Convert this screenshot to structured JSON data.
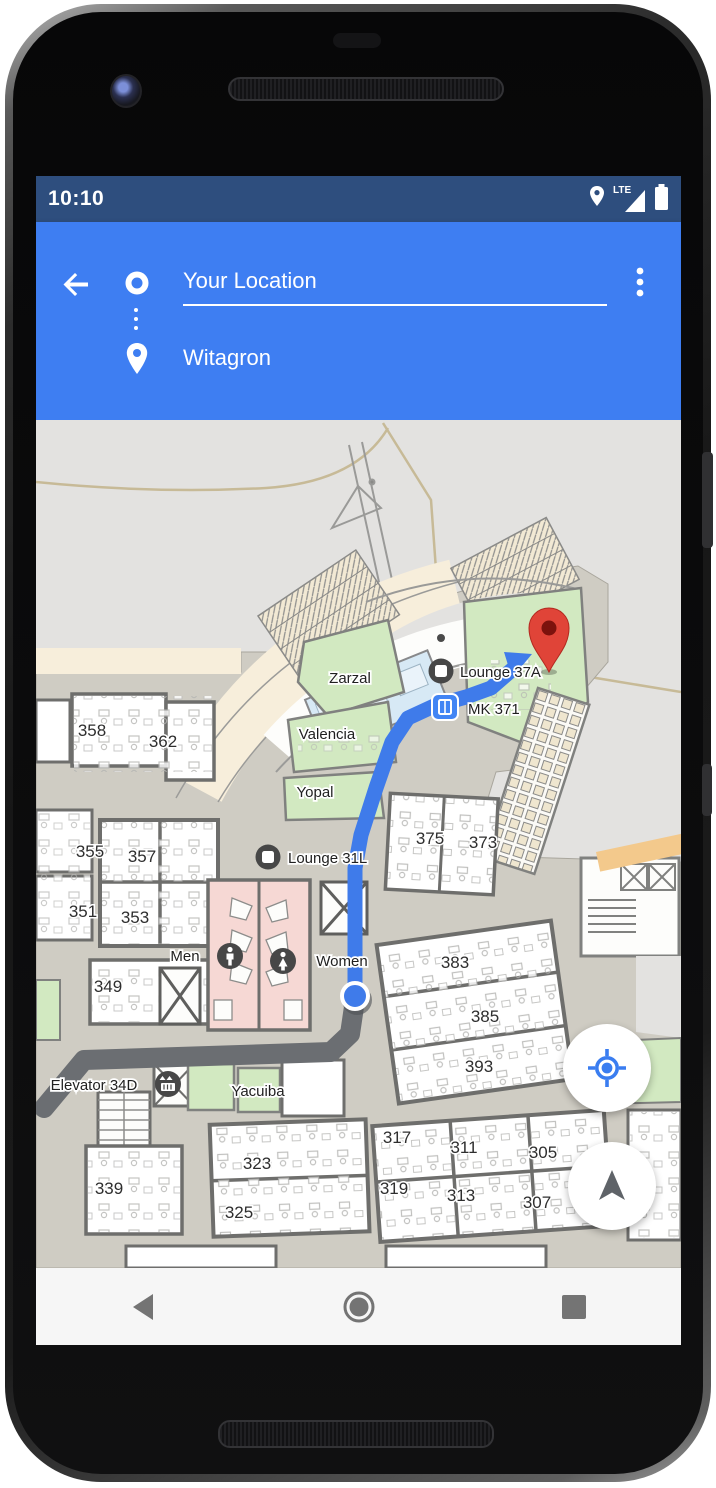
{
  "status_bar": {
    "time": "10:10",
    "network_label": "LTE",
    "icons": [
      "location-pin",
      "signal-triangle",
      "battery-full"
    ]
  },
  "directions_header": {
    "origin_value": "Your Location",
    "destination_value": "Witagron",
    "accent_color": "#3e7ef2",
    "status_color": "#2e4e7e"
  },
  "map": {
    "colors": {
      "outdoor": "#e3e2e0",
      "corridor": "#cfccc3",
      "building_trim": "#f7eedb",
      "room_green": "#d2e9c1",
      "room_pink": "#f6d8d4",
      "room_blue": "#d7e9f5",
      "route_blue": "#3f7bea",
      "route_gray": "#6b6e72",
      "pin_red": "#e04438",
      "accent_strip": "#f3c98c"
    },
    "room_numbers": [
      {
        "t": "358",
        "x": 56,
        "y": 316
      },
      {
        "t": "362",
        "x": 127,
        "y": 327
      },
      {
        "t": "355",
        "x": 54,
        "y": 437
      },
      {
        "t": "357",
        "x": 106,
        "y": 442
      },
      {
        "t": "351",
        "x": 47,
        "y": 497
      },
      {
        "t": "353",
        "x": 99,
        "y": 503
      },
      {
        "t": "349",
        "x": 72,
        "y": 572
      },
      {
        "t": "339",
        "x": 73,
        "y": 774
      },
      {
        "t": "323",
        "x": 221,
        "y": 749
      },
      {
        "t": "325",
        "x": 203,
        "y": 798
      },
      {
        "t": "375",
        "x": 394,
        "y": 424
      },
      {
        "t": "373",
        "x": 447,
        "y": 428
      },
      {
        "t": "383",
        "x": 419,
        "y": 548
      },
      {
        "t": "385",
        "x": 449,
        "y": 602
      },
      {
        "t": "393",
        "x": 443,
        "y": 652
      },
      {
        "t": "317",
        "x": 361,
        "y": 723
      },
      {
        "t": "311",
        "x": 428,
        "y": 733
      },
      {
        "t": "305",
        "x": 507,
        "y": 738
      },
      {
        "t": "319",
        "x": 358,
        "y": 774
      },
      {
        "t": "313",
        "x": 425,
        "y": 781
      },
      {
        "t": "307",
        "x": 501,
        "y": 788
      }
    ],
    "place_labels": [
      {
        "t": "Zarzal",
        "x": 314,
        "y": 263,
        "a": "middle"
      },
      {
        "t": "Valencia",
        "x": 291,
        "y": 319,
        "a": "middle"
      },
      {
        "t": "Yopal",
        "x": 279,
        "y": 377,
        "a": "middle"
      },
      {
        "t": "Lounge 37A",
        "x": 424,
        "y": 257,
        "a": "start"
      },
      {
        "t": "MK 371",
        "x": 432,
        "y": 294,
        "a": "start"
      },
      {
        "t": "Lounge 31L",
        "x": 252,
        "y": 443,
        "a": "start"
      },
      {
        "t": "Men",
        "x": 149,
        "y": 541,
        "a": "middle"
      },
      {
        "t": "Women",
        "x": 306,
        "y": 546,
        "a": "middle"
      },
      {
        "t": "Elevator 34D",
        "x": 58,
        "y": 670,
        "a": "middle"
      },
      {
        "t": "Yacuiba",
        "x": 222,
        "y": 676,
        "a": "middle"
      }
    ],
    "poi_icons": [
      "lounge-icon",
      "elevator-mk371-icon",
      "lounge-31l-icon",
      "men-restroom-icon",
      "women-restroom-icon",
      "elevator-34d-icon"
    ],
    "route": {
      "origin_marker": "blue-location-dot",
      "destination_marker": "red-pin",
      "traveled_segment_color": "#6b6e72",
      "active_segment_color": "#3f7bea"
    }
  },
  "fabs": [
    {
      "name": "my-location",
      "icon": "crosshair-target"
    },
    {
      "name": "compass",
      "icon": "navigation-arrow"
    }
  ],
  "nav_bar": {
    "buttons": [
      "back",
      "home",
      "recents"
    ]
  }
}
